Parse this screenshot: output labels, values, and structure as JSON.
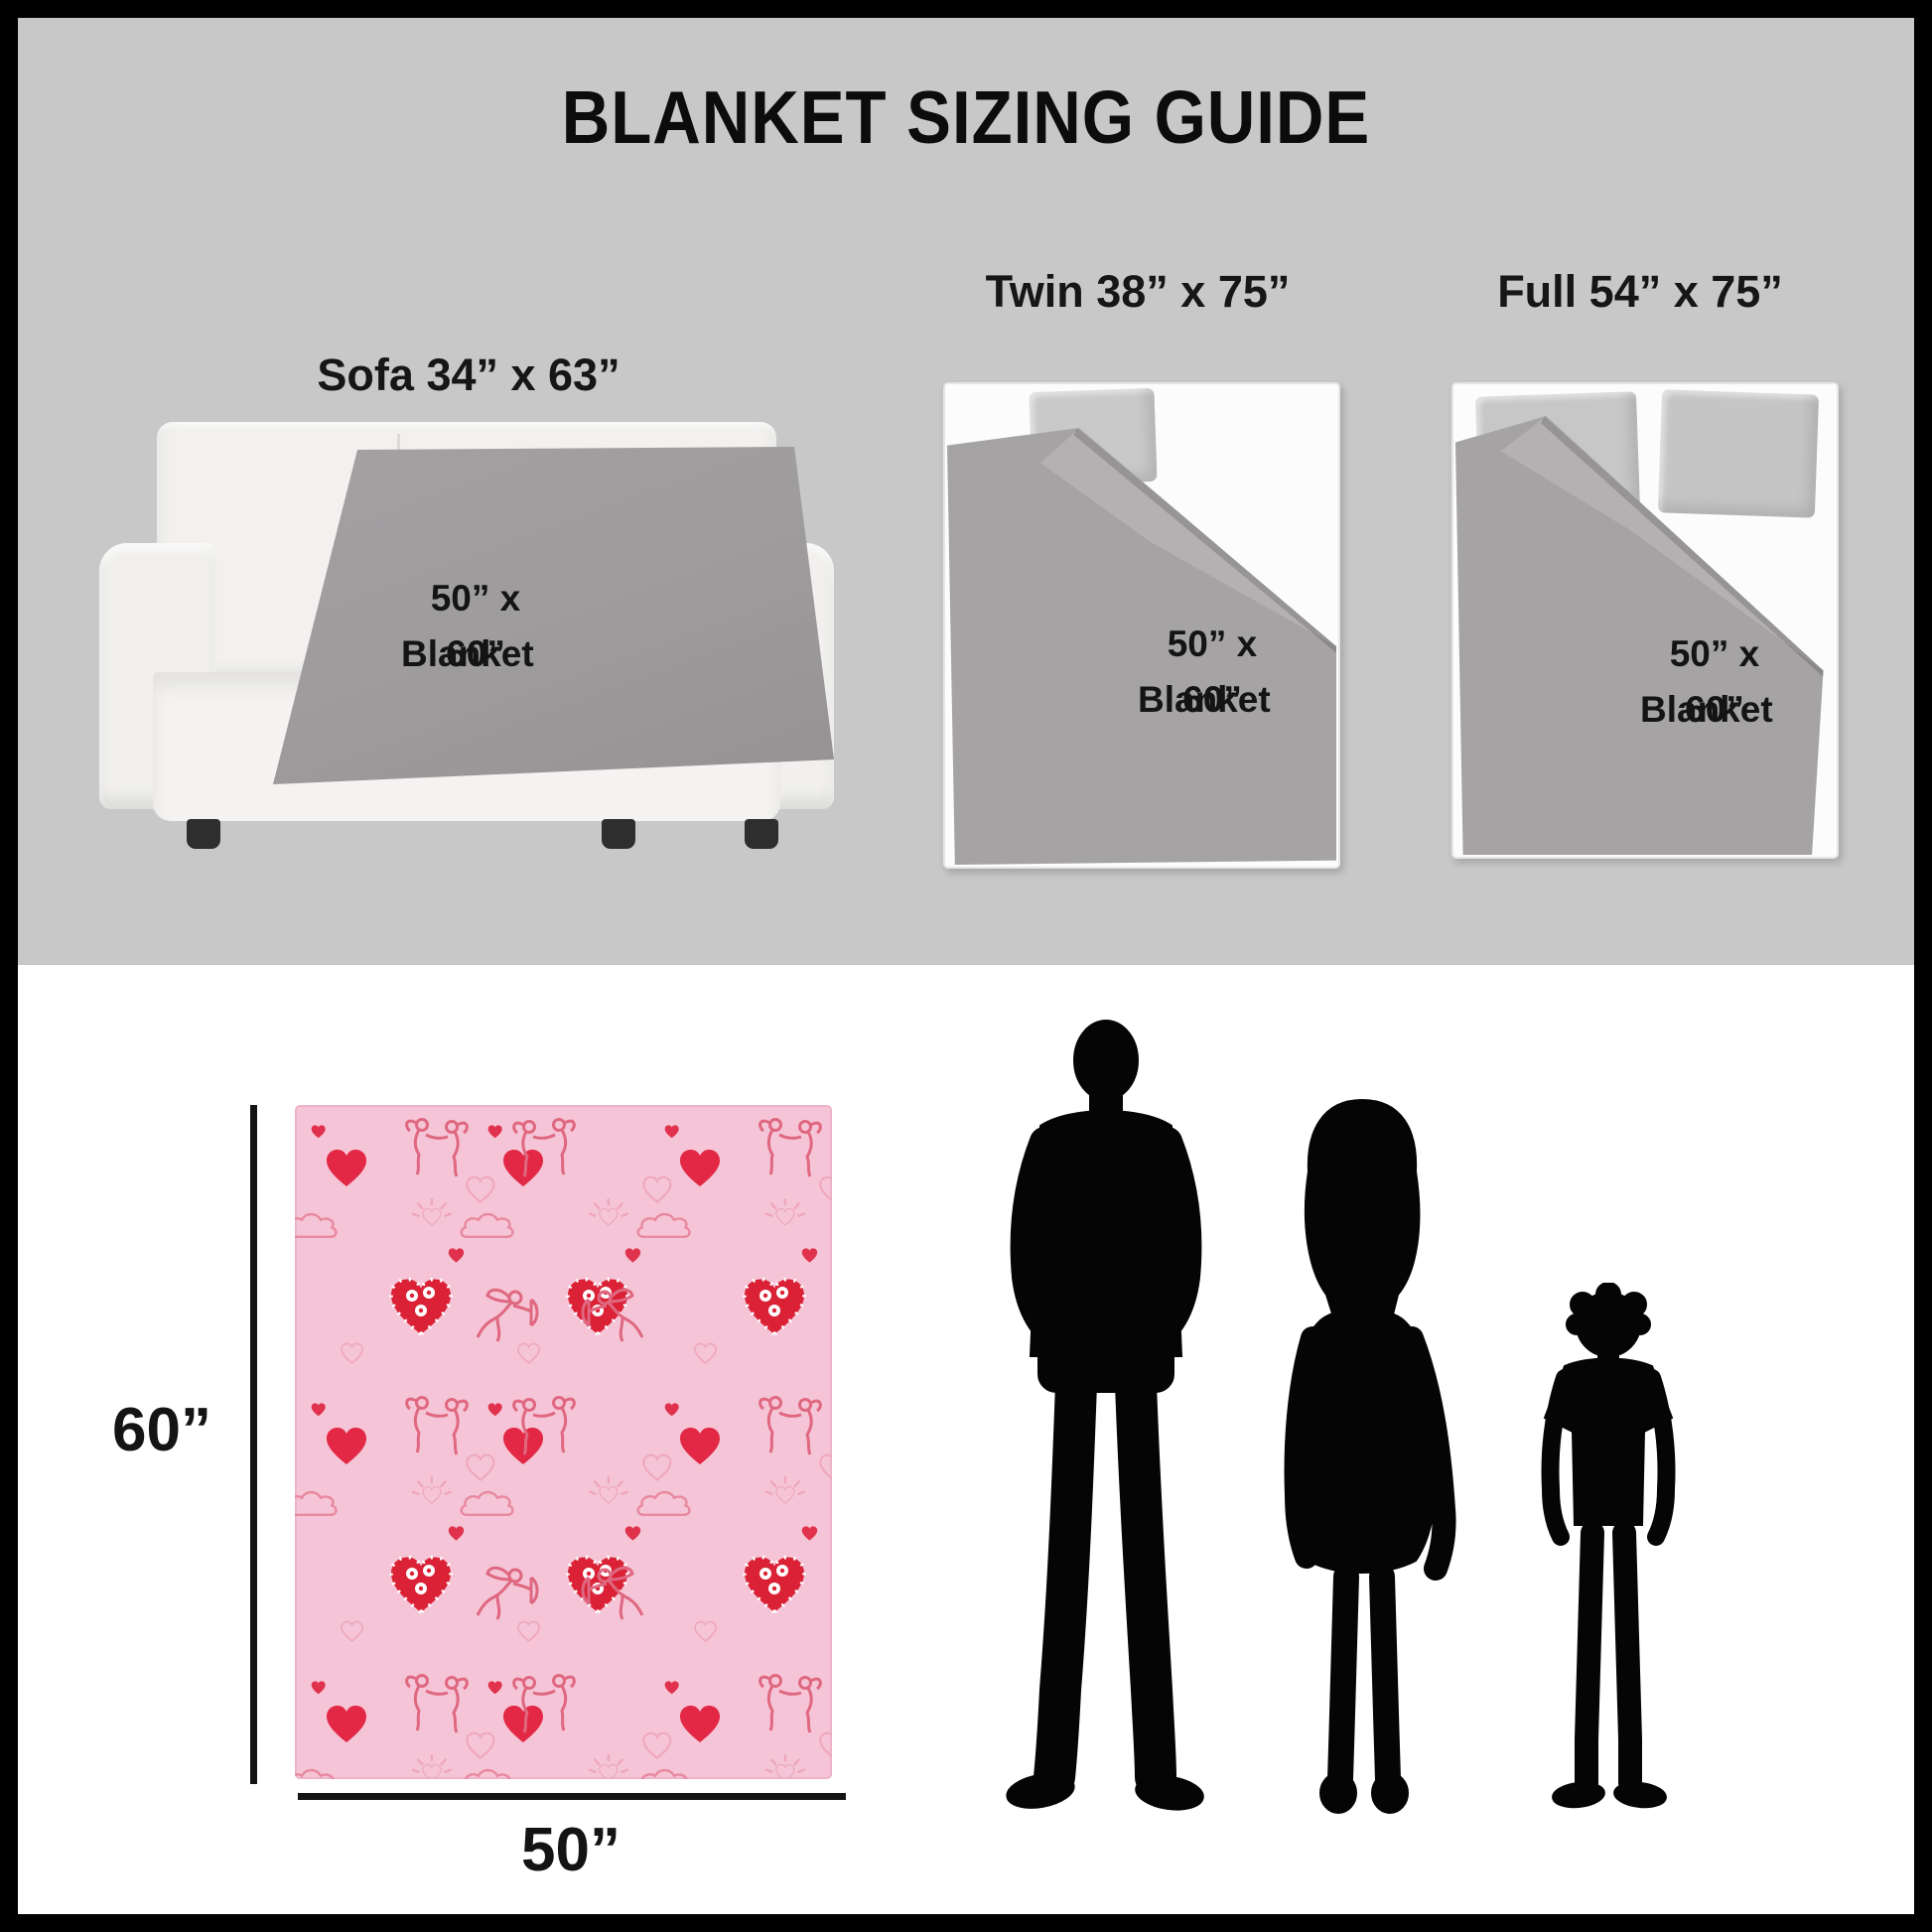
{
  "title": "BLANKET SIZING GUIDE",
  "comparisons": [
    {
      "kind": "sofa",
      "label": "Sofa 34” x 63”",
      "blanket_size": "50” x 60”",
      "blanket_word": "Blanket"
    },
    {
      "kind": "twin-bed",
      "label": "Twin 38” x 75”",
      "blanket_size": "50” x 60”",
      "blanket_word": "Blanket"
    },
    {
      "kind": "full-bed",
      "label": "Full 54” x 75”",
      "blanket_size": "50” x 60”",
      "blanket_word": "Blanket"
    }
  ],
  "dimensions": {
    "height_label": "60”",
    "width_label": "50”"
  },
  "figures": [
    {
      "icon": "man-silhouette"
    },
    {
      "icon": "woman-silhouette"
    },
    {
      "icon": "boy-silhouette"
    }
  ],
  "colors": {
    "panel_gray": "#c8c8c8",
    "section_white": "#ffffff",
    "border_black": "#000000",
    "throw_gray": "#9d9b9c",
    "duvet_gray": "#a5a3a4",
    "bed_white": "#fcfcfc",
    "pillow_gray": "#c9c9c9",
    "blanket_pink": "#f5c5d7",
    "heart_red": "#e22844",
    "pattern_pink": "#e2748c",
    "silhouette_black": "#050505"
  }
}
